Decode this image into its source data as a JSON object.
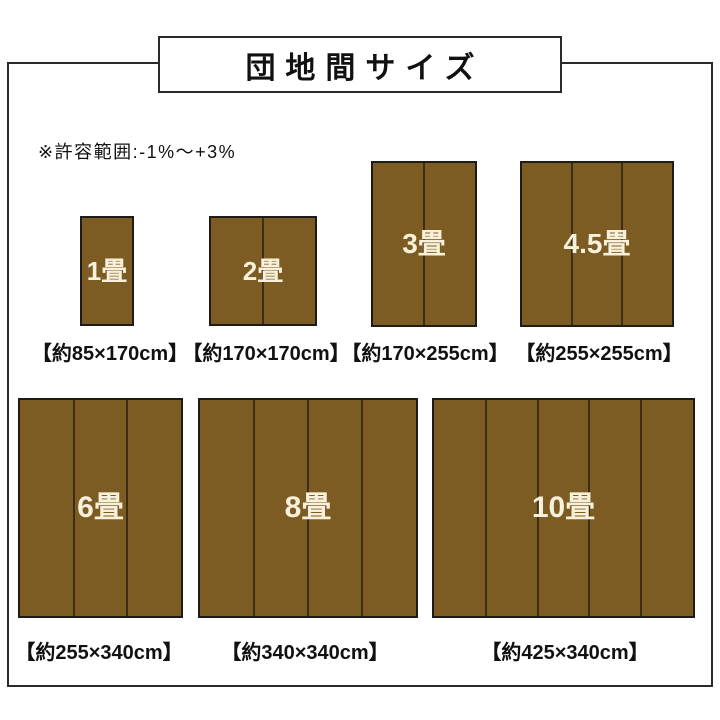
{
  "page": {
    "title": "団地間サイズ",
    "tolerance_note": "※許容範囲:-1%〜+3%"
  },
  "colors": {
    "background": "#ffffff",
    "frame_border": "#2b2b2b",
    "text": "#111111",
    "mat_fill": "#7d5c24",
    "mat_border": "#1f1c17",
    "mat_divider": "#3e2c14",
    "mat_label": "#f7f0da"
  },
  "mats": [
    {
      "name": "1畳",
      "size_label": "【約85×170cm】",
      "width_cm": 85,
      "height_cm": 170,
      "panels": 1
    },
    {
      "name": "2畳",
      "size_label": "【約170×170cm】",
      "width_cm": 170,
      "height_cm": 170,
      "panels": 2
    },
    {
      "name": "3畳",
      "size_label": "【約170×255cm】",
      "width_cm": 170,
      "height_cm": 255,
      "panels": 2
    },
    {
      "name": "4.5畳",
      "size_label": "【約255×255cm】",
      "width_cm": 255,
      "height_cm": 255,
      "panels": 3
    },
    {
      "name": "6畳",
      "size_label": "【約255×340cm】",
      "width_cm": 255,
      "height_cm": 340,
      "panels": 3
    },
    {
      "name": "8畳",
      "size_label": "【約340×340cm】",
      "width_cm": 340,
      "height_cm": 340,
      "panels": 4
    },
    {
      "name": "10畳",
      "size_label": "【約425×340cm】",
      "width_cm": 425,
      "height_cm": 340,
      "panels": 5
    }
  ]
}
